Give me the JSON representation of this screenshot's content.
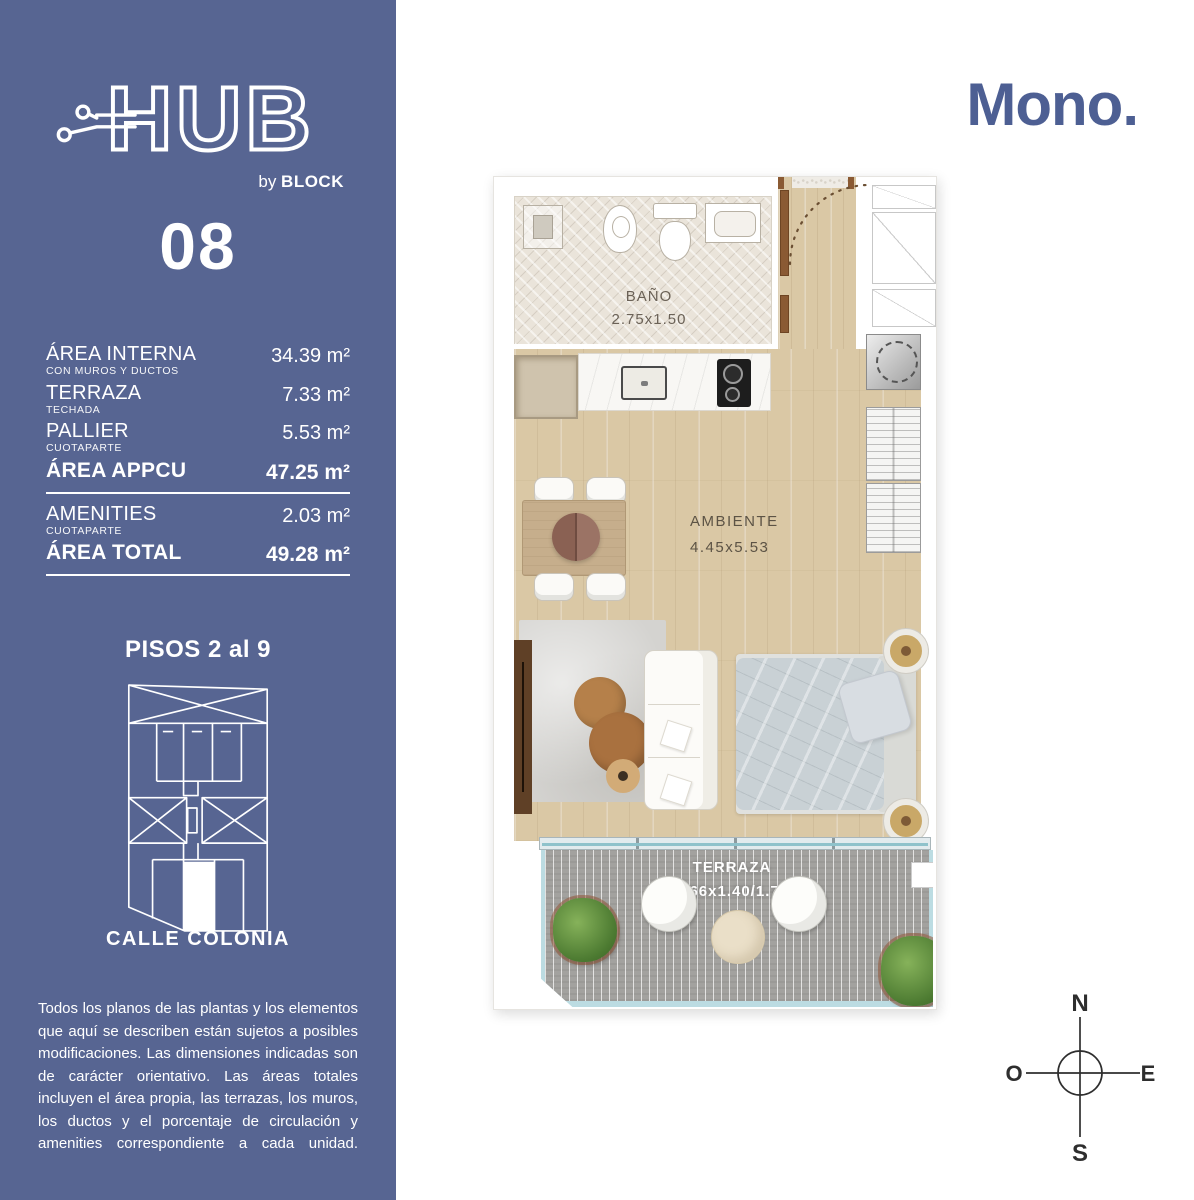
{
  "colors": {
    "sidebar-bg": "#576592",
    "accent": "#4d5f93",
    "wood": "#dac8a5",
    "bath-tile": "#eae4da",
    "deck": "#a3a29f",
    "railing": "#bcdce2",
    "plan-label": "#5c5345",
    "compass": "#2e2e2e"
  },
  "sidebar": {
    "logo": {
      "text": "HUB",
      "by": "by ",
      "block": "BLOCK"
    },
    "unit_number": "08",
    "areas": [
      {
        "label": "ÁREA INTERNA",
        "sublabel": "CON MUROS Y DUCTOS",
        "value": "34.39 m²"
      },
      {
        "label": "TERRAZA",
        "sublabel": "TECHADA",
        "value": "7.33 m²"
      },
      {
        "label": "PALLIER",
        "sublabel": "CUOTAPARTE",
        "value": "5.53 m²"
      },
      {
        "label": "ÁREA APPCU",
        "sublabel": "",
        "value": "47.25 m²"
      },
      {
        "label": "AMENITIES",
        "sublabel": "CUOTAPARTE",
        "value": "2.03 m²"
      },
      {
        "label": "ÁREA TOTAL",
        "sublabel": "",
        "value": "49.28 m²"
      }
    ],
    "floors_label": "PISOS 2 al 9",
    "street_label": "CALLE COLONIA",
    "disclaimer": "Todos los planos de las plantas y los elementos que aquí se describen están sujetos a posibles modificaciones. Las dimensiones indicadas son de carácter orientativo. Las áreas totales incluyen el área propia, las terrazas, los muros, los ductos y el porcentaje de circulación y amenities correspondiente a cada unidad."
  },
  "main": {
    "unit_type": "Mono.",
    "floorplan": {
      "rooms": [
        {
          "name": "BAÑO",
          "dimensions": "2.75x1.50"
        },
        {
          "name": "AMBIENTE",
          "dimensions": "4.45x5.53"
        },
        {
          "name": "TERRAZA",
          "dimensions": "4.66x1.40/1.75"
        }
      ]
    },
    "compass": {
      "north": "N",
      "south": "S",
      "east": "E",
      "west": "O"
    }
  }
}
